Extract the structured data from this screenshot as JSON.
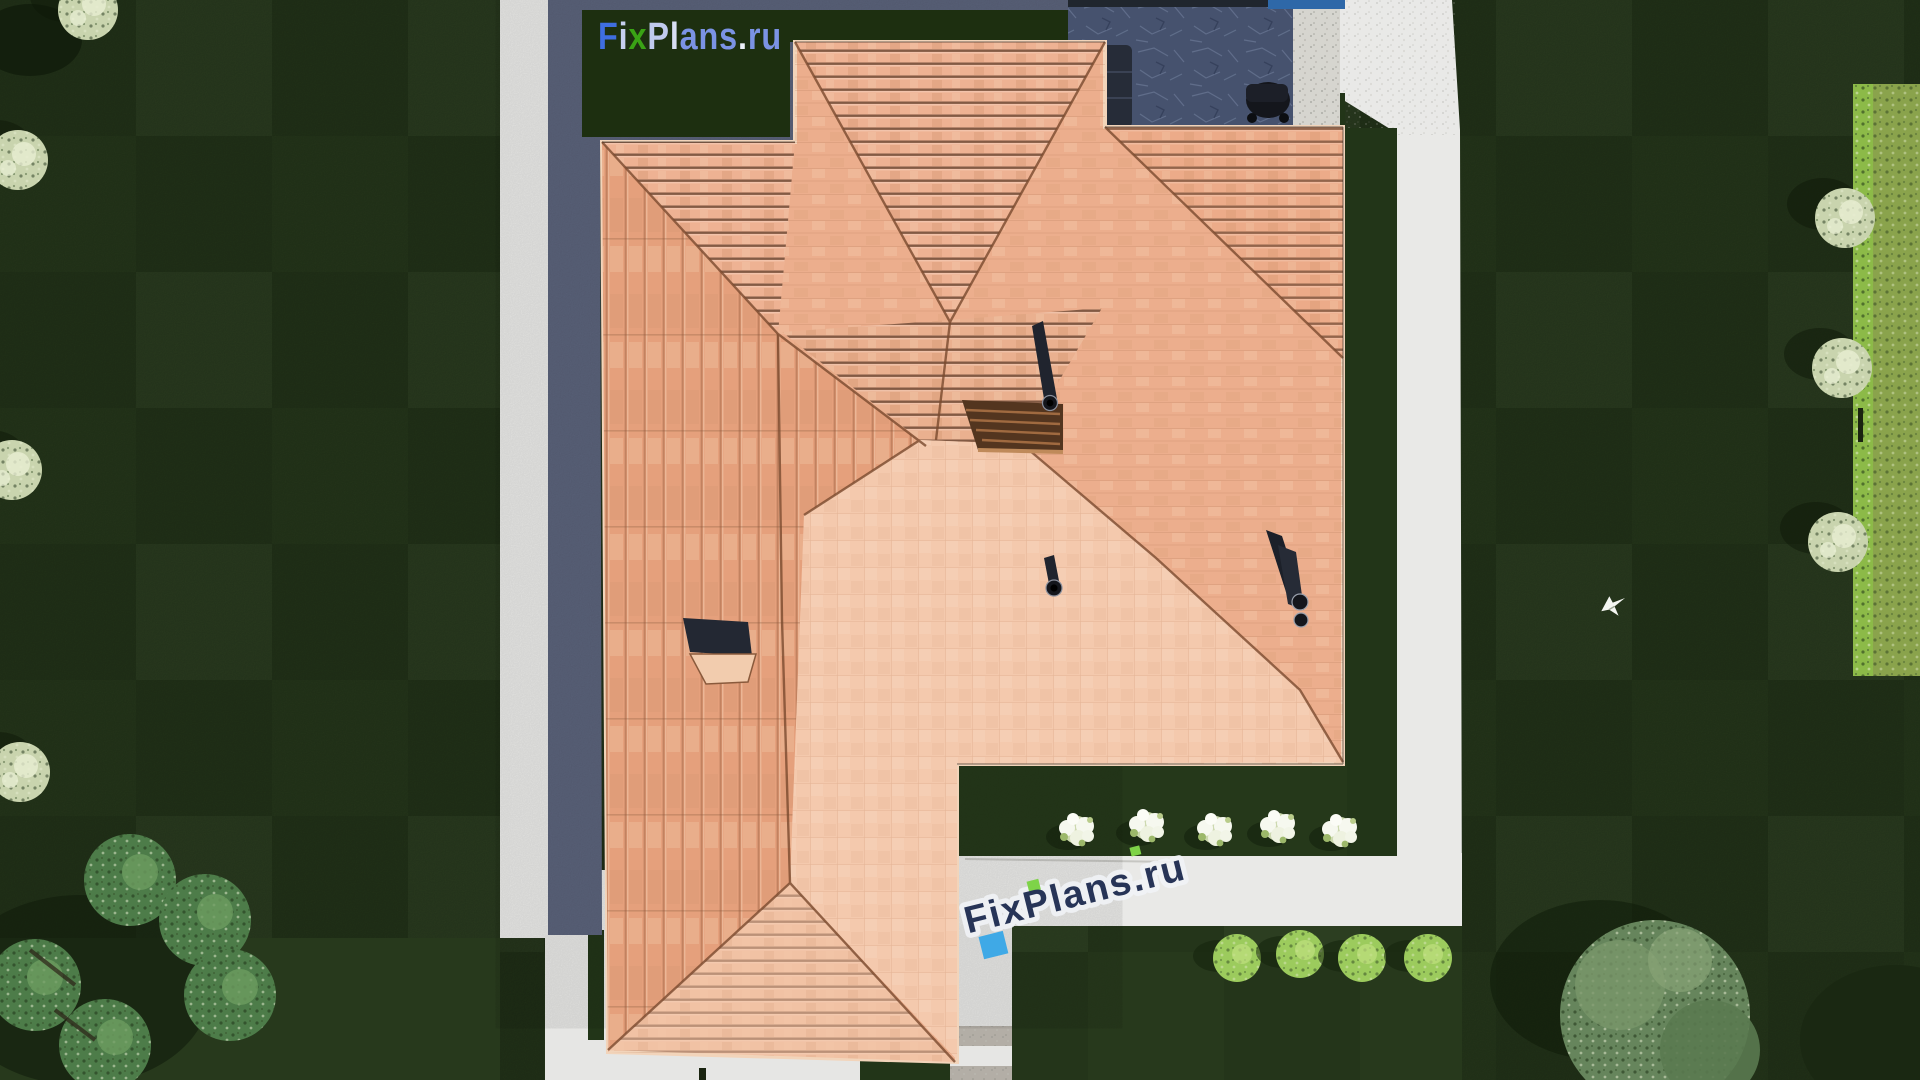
{
  "brand_logo": {
    "text": "FixPlans.ru",
    "background": "#1d2f10",
    "segments": [
      {
        "t": "F",
        "c": "#3f6ee0"
      },
      {
        "t": "i",
        "c": "#c6cfee"
      },
      {
        "t": "x",
        "c": "#3aa315"
      },
      {
        "t": "P",
        "c": "#c0cbee"
      },
      {
        "t": "l",
        "c": "#d8def4"
      },
      {
        "t": "a",
        "c": "#7b93e4"
      },
      {
        "t": "n",
        "c": "#7b93e4"
      },
      {
        "t": "s",
        "c": "#7b93e4"
      },
      {
        "t": ".",
        "c": "#eef2fb"
      },
      {
        "t": "r",
        "c": "#7b93e4"
      },
      {
        "t": "u",
        "c": "#7b93e4"
      }
    ]
  },
  "watermark": {
    "text": "FixPlans.ru",
    "text_color": "#273457",
    "halo_color": "#f1f3f7",
    "accent_blue": "#3fa9e6",
    "accent_green": "#7ed348",
    "rotation_deg": -14
  },
  "colors": {
    "lawn": "#27391c",
    "lawn_neighbor": "#8aa34c",
    "hedge": "#8cba48",
    "path": "#e9e9e7",
    "house_shadow": "#5b637b",
    "roof_base": "#ecae8d",
    "roof_pale": "#f4c9ad",
    "roof_ridge": "#7a4a2e",
    "patio_slate": "#46526e",
    "patio_wall": "#d6d5cf",
    "pool": "#2e68a8",
    "pergola_wood": "#53351f",
    "flower_white": "#f6f8ef",
    "bush_green": "#9ccb5d",
    "tree_pale": "#c9d4ae",
    "tree_green": "#4d7c49",
    "tree_gray_green": "#66855c",
    "chimney_dark": "#20242e"
  }
}
